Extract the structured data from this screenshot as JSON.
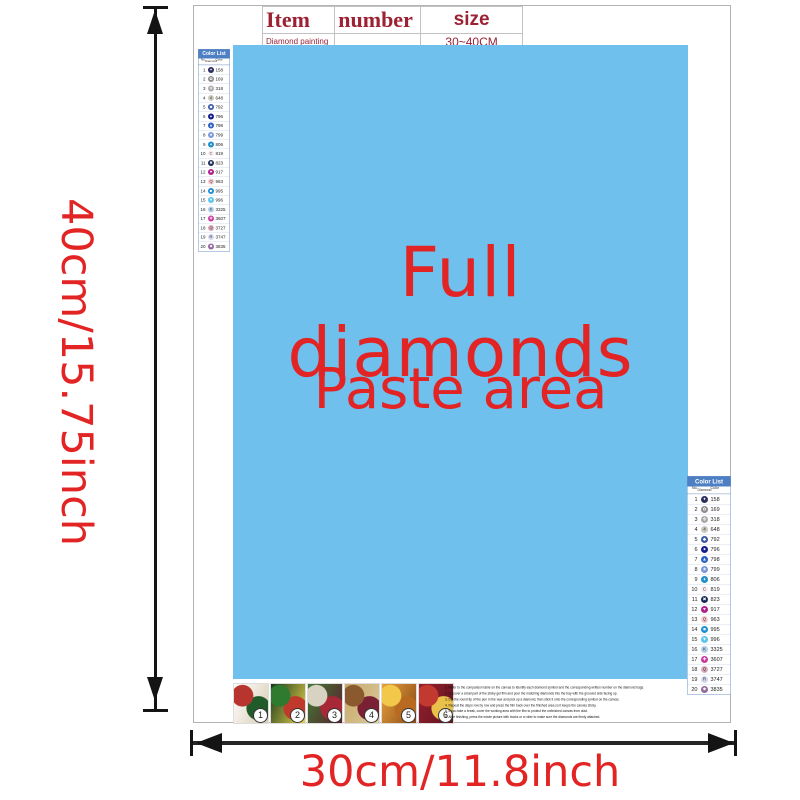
{
  "labels": {
    "height": "40cm/15.75inch",
    "width": "30cm/11.8inch",
    "full_diamonds": "Full diamonds",
    "paste_area": "Paste area"
  },
  "item_table": {
    "headers": [
      "Item",
      "number",
      "size"
    ],
    "row": [
      "Diamond painting",
      "",
      "30~40CM"
    ]
  },
  "color_list": {
    "title": "Color List",
    "columns": [
      "No.",
      "Diamond",
      "Color"
    ],
    "rows": [
      {
        "no": "1",
        "code": "158",
        "circle": "#2b2d5e",
        "symbol": "✦",
        "symbol_color": "#ffffff"
      },
      {
        "no": "2",
        "code": "169",
        "circle": "#8c8c8c",
        "symbol": "✿",
        "symbol_color": "#ffffff"
      },
      {
        "no": "3",
        "code": "318",
        "circle": "#a9a9a9",
        "symbol": "✜",
        "symbol_color": "#ffffff"
      },
      {
        "no": "4",
        "code": "648",
        "circle": "#c9c9bd",
        "symbol": "4",
        "symbol_color": "#333333"
      },
      {
        "no": "5",
        "code": "792",
        "circle": "#3a57a8",
        "symbol": "◆",
        "symbol_color": "#ffffff"
      },
      {
        "no": "6",
        "code": "796",
        "circle": "#141f8f",
        "symbol": "●",
        "symbol_color": "#ffffff"
      },
      {
        "no": "7",
        "code": "798",
        "circle": "#2b61c4",
        "symbol": "▲",
        "symbol_color": "#ffffff"
      },
      {
        "no": "8",
        "code": "799",
        "circle": "#7b97da",
        "symbol": "★",
        "symbol_color": "#ffffff"
      },
      {
        "no": "9",
        "code": "806",
        "circle": "#1e8fc9",
        "symbol": "♦",
        "symbol_color": "#ffffff"
      },
      {
        "no": "10",
        "code": "819",
        "circle": "#f9edf0",
        "symbol": "C",
        "symbol_color": "#333333"
      },
      {
        "no": "11",
        "code": "823",
        "circle": "#1b2a5c",
        "symbol": "✖",
        "symbol_color": "#ffffff"
      },
      {
        "no": "12",
        "code": "917",
        "circle": "#b01f8e",
        "symbol": "♥",
        "symbol_color": "#ffffff"
      },
      {
        "no": "13",
        "code": "963",
        "circle": "#f6c9cf",
        "symbol": "Q",
        "symbol_color": "#333333"
      },
      {
        "no": "14",
        "code": "995",
        "circle": "#1f8fd6",
        "symbol": "■",
        "symbol_color": "#ffffff"
      },
      {
        "no": "15",
        "code": "996",
        "circle": "#5ac3ee",
        "symbol": "▼",
        "symbol_color": "#ffffff"
      },
      {
        "no": "16",
        "code": "3325",
        "circle": "#b3d0ea",
        "symbol": "K",
        "symbol_color": "#333333"
      },
      {
        "no": "17",
        "code": "3607",
        "circle": "#c8399f",
        "symbol": "✚",
        "symbol_color": "#ffffff"
      },
      {
        "no": "18",
        "code": "3727",
        "circle": "#dcaabb",
        "symbol": "Q",
        "symbol_color": "#333333"
      },
      {
        "no": "19",
        "code": "3747",
        "circle": "#d6d6f0",
        "symbol": "R",
        "symbol_color": "#333333"
      },
      {
        "no": "20",
        "code": "3835",
        "circle": "#95679f",
        "symbol": "✹",
        "symbol_color": "#ffffff"
      }
    ]
  },
  "bottom": {
    "thumbnails": [
      {
        "label": "1",
        "colors": [
          "#b8352f",
          "#225b2a",
          "#ffffff",
          "#d9cbb4"
        ]
      },
      {
        "label": "2",
        "colors": [
          "#2e7a2e",
          "#c03a2c",
          "#16391c",
          "#e8d24a"
        ]
      },
      {
        "label": "3",
        "colors": [
          "#d8d2c2",
          "#a82837",
          "#3f7a35",
          "#5c1f2e"
        ]
      },
      {
        "label": "4",
        "colors": [
          "#8a5a2e",
          "#7a2035",
          "#c9a96a",
          "#d9c89a"
        ]
      },
      {
        "label": "5",
        "colors": [
          "#f2c84b",
          "#b86a20",
          "#e8a13a",
          "#8a4a1a"
        ]
      },
      {
        "label": "6",
        "colors": [
          "#c23a2f",
          "#e8c04a",
          "#9a1f2d",
          "#5c1520"
        ]
      }
    ],
    "instructions": [
      "1. Refer to the comparison table on the canvas to identify each diamond symbol and the corresponding written number on the diamond bags.",
      "2. Uncover a small part of the sticky gel film and pour the matching diamonds into the tray with the grooved side facing up.",
      "3. Dip the round tip of the pen in the wax and pick up a diamond, then stick it onto the corresponding symbol on the canvas.",
      "4. Repeat the steps row by row and press the film back over the finished area so it keeps the canvas sticky.",
      "5. If you take a break, cover the working area with the film to protect the unfinished canvas from dust.",
      "6. After finishing, press the whole picture with books or a roller to make sure the diamonds are firmly attached."
    ]
  },
  "colors": {
    "accent_red": "#e22424",
    "table_text_red": "#9c2133",
    "paste_blue": "#6fc0ec",
    "list_header_blue": "#4d7fc4",
    "arrow_black": "#141414"
  }
}
